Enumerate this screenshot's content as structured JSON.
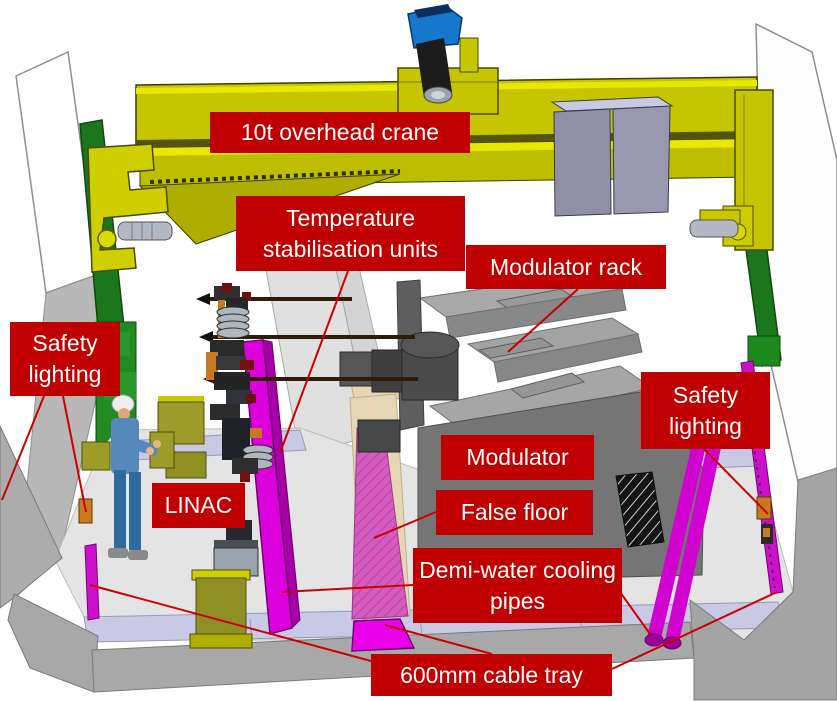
{
  "labels": {
    "crane": "10t overhead crane",
    "temp_units": "Temperature stabilisation units",
    "modulator_rack": "Modulator rack",
    "safety_left": "Safety lighting",
    "safety_right": "Safety lighting",
    "modulator": "Modulator",
    "false_floor": "False floor",
    "linac": "LINAC",
    "demi_water": "Demi-water cooling pipes",
    "cable_tray": "600mm cable tray"
  },
  "colors": {
    "label_background": "#c00000",
    "label_text": "#ffffff",
    "leader_line": "#cc0000",
    "crane_yellow": "#c6c600",
    "rail_green": "#1c771c",
    "cable_tray_magenta": "#cc10cc",
    "cooling_pipe_strip_pink": "#d45cbe",
    "false_floor_tan": "#e6d6b4",
    "floor_trench_lavender": "#c9c9e6",
    "hoist_blue": "#1678cc",
    "modulator_gray": "#757575"
  }
}
